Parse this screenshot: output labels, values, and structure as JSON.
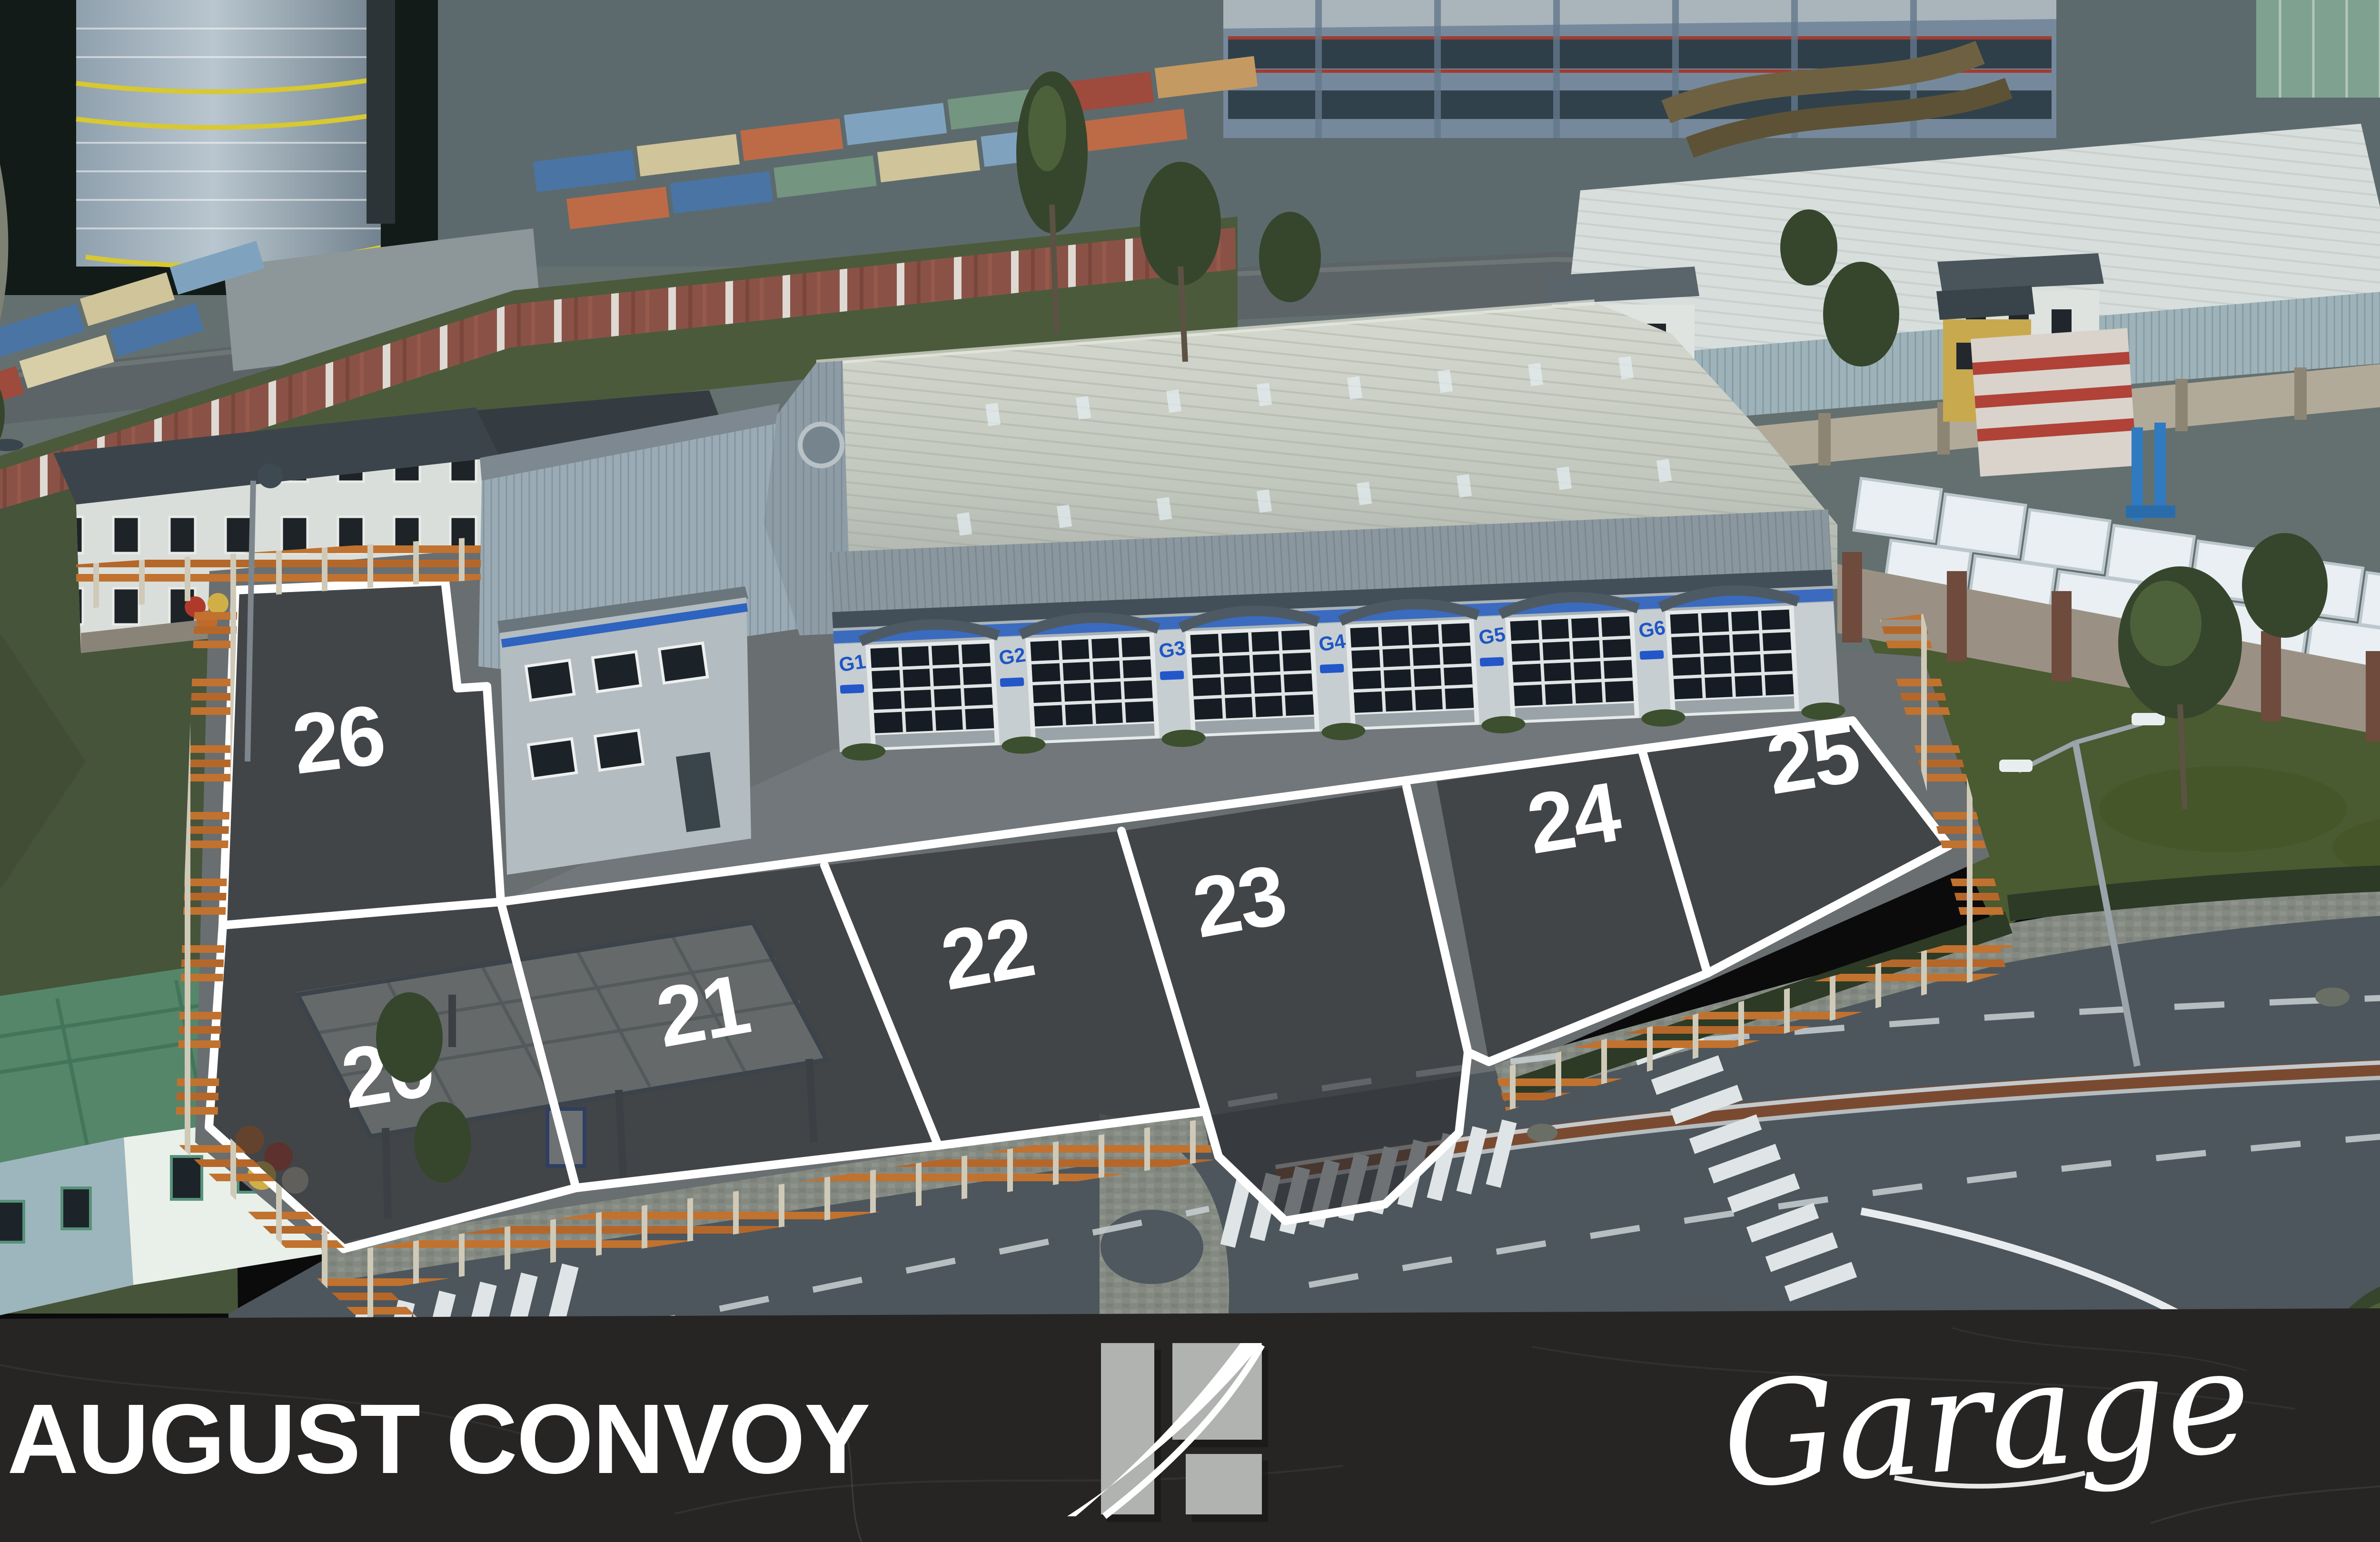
{
  "banner": {
    "title": "AUGUST CONVOY",
    "wordmark": "Garage",
    "logo_name": "convoy-road-logo"
  },
  "zones": [
    {
      "number": "26"
    },
    {
      "number": "20"
    },
    {
      "number": "21"
    },
    {
      "number": "22"
    },
    {
      "number": "23"
    },
    {
      "number": "24"
    },
    {
      "number": "25"
    }
  ],
  "garage": {
    "doors": [
      {
        "label": "G1"
      },
      {
        "label": "G2"
      },
      {
        "label": "G3"
      },
      {
        "label": "G4"
      },
      {
        "label": "G5"
      },
      {
        "label": "G6"
      }
    ]
  },
  "colors": {
    "banner_bg": "#26242305",
    "banner_base": "#272524",
    "zone_fill": "#3a3b3f",
    "zone_outline": "#ffffff",
    "fence_orange": "#c1722f",
    "garage_stripe": "#2e63c0",
    "logo_gray": "#b0b3af",
    "road": "#4d565c",
    "grass": "#46543a"
  }
}
